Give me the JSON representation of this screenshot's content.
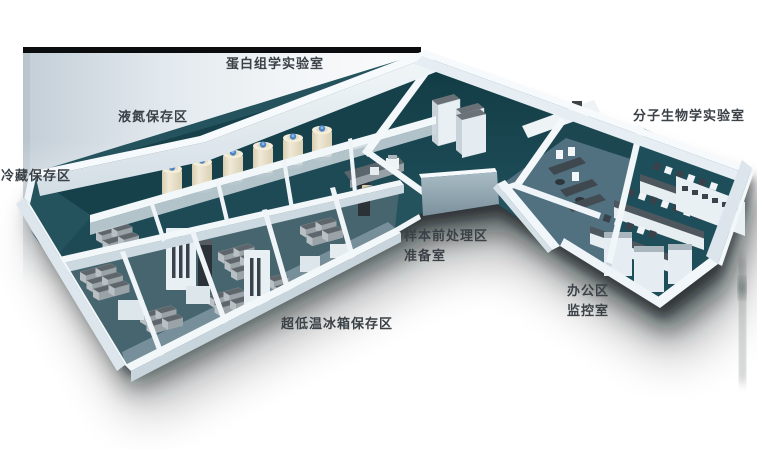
{
  "scene": {
    "type": "3d-isometric-floorplan",
    "description": "Rendered 3D cutaway floor plan of a biobank / laboratory suite, L-shaped building with teal floors and white walls, soft drop shadow on white background",
    "labels": [
      {
        "id": "proteomics-lab",
        "text": "蛋白组学实验室"
      },
      {
        "id": "liquid-nitrogen-area",
        "text": "液氮保存区"
      },
      {
        "id": "cold-storage-area",
        "text": "冷藏保存区"
      },
      {
        "id": "molecular-biology-lab",
        "text": "分子生物学实验室"
      },
      {
        "id": "sample-pretreatment",
        "text": "样本前处理区"
      },
      {
        "id": "prep-room",
        "text": "准备室"
      },
      {
        "id": "office-area",
        "text": "办公区"
      },
      {
        "id": "monitoring-room",
        "text": "监控室"
      },
      {
        "id": "ult-freezer-area",
        "text": "超低温冰箱保存区"
      }
    ],
    "palette": {
      "page_bg": "#ffffff",
      "label_color": "#3a4147",
      "backdrop_bar": "#0a0c0d",
      "backdrop_left": "#c3ced7",
      "backdrop_right": "#f6f8fa",
      "floor_teal_dark": "#17434d",
      "floor_teal_mid": "#24525d",
      "floor_office": "#527180",
      "wall_white": "#f4f8fa",
      "wall_face": "#ccd8df",
      "chamfer_wall": "#8ea3ae",
      "freezer_top": "#5e666b",
      "freezer_front": "#9aa3a8",
      "tank_body": "#e7dfc7",
      "tank_cap": "#4a84c4",
      "bench_top": "#4e575d",
      "shadow": "#06090b"
    }
  }
}
